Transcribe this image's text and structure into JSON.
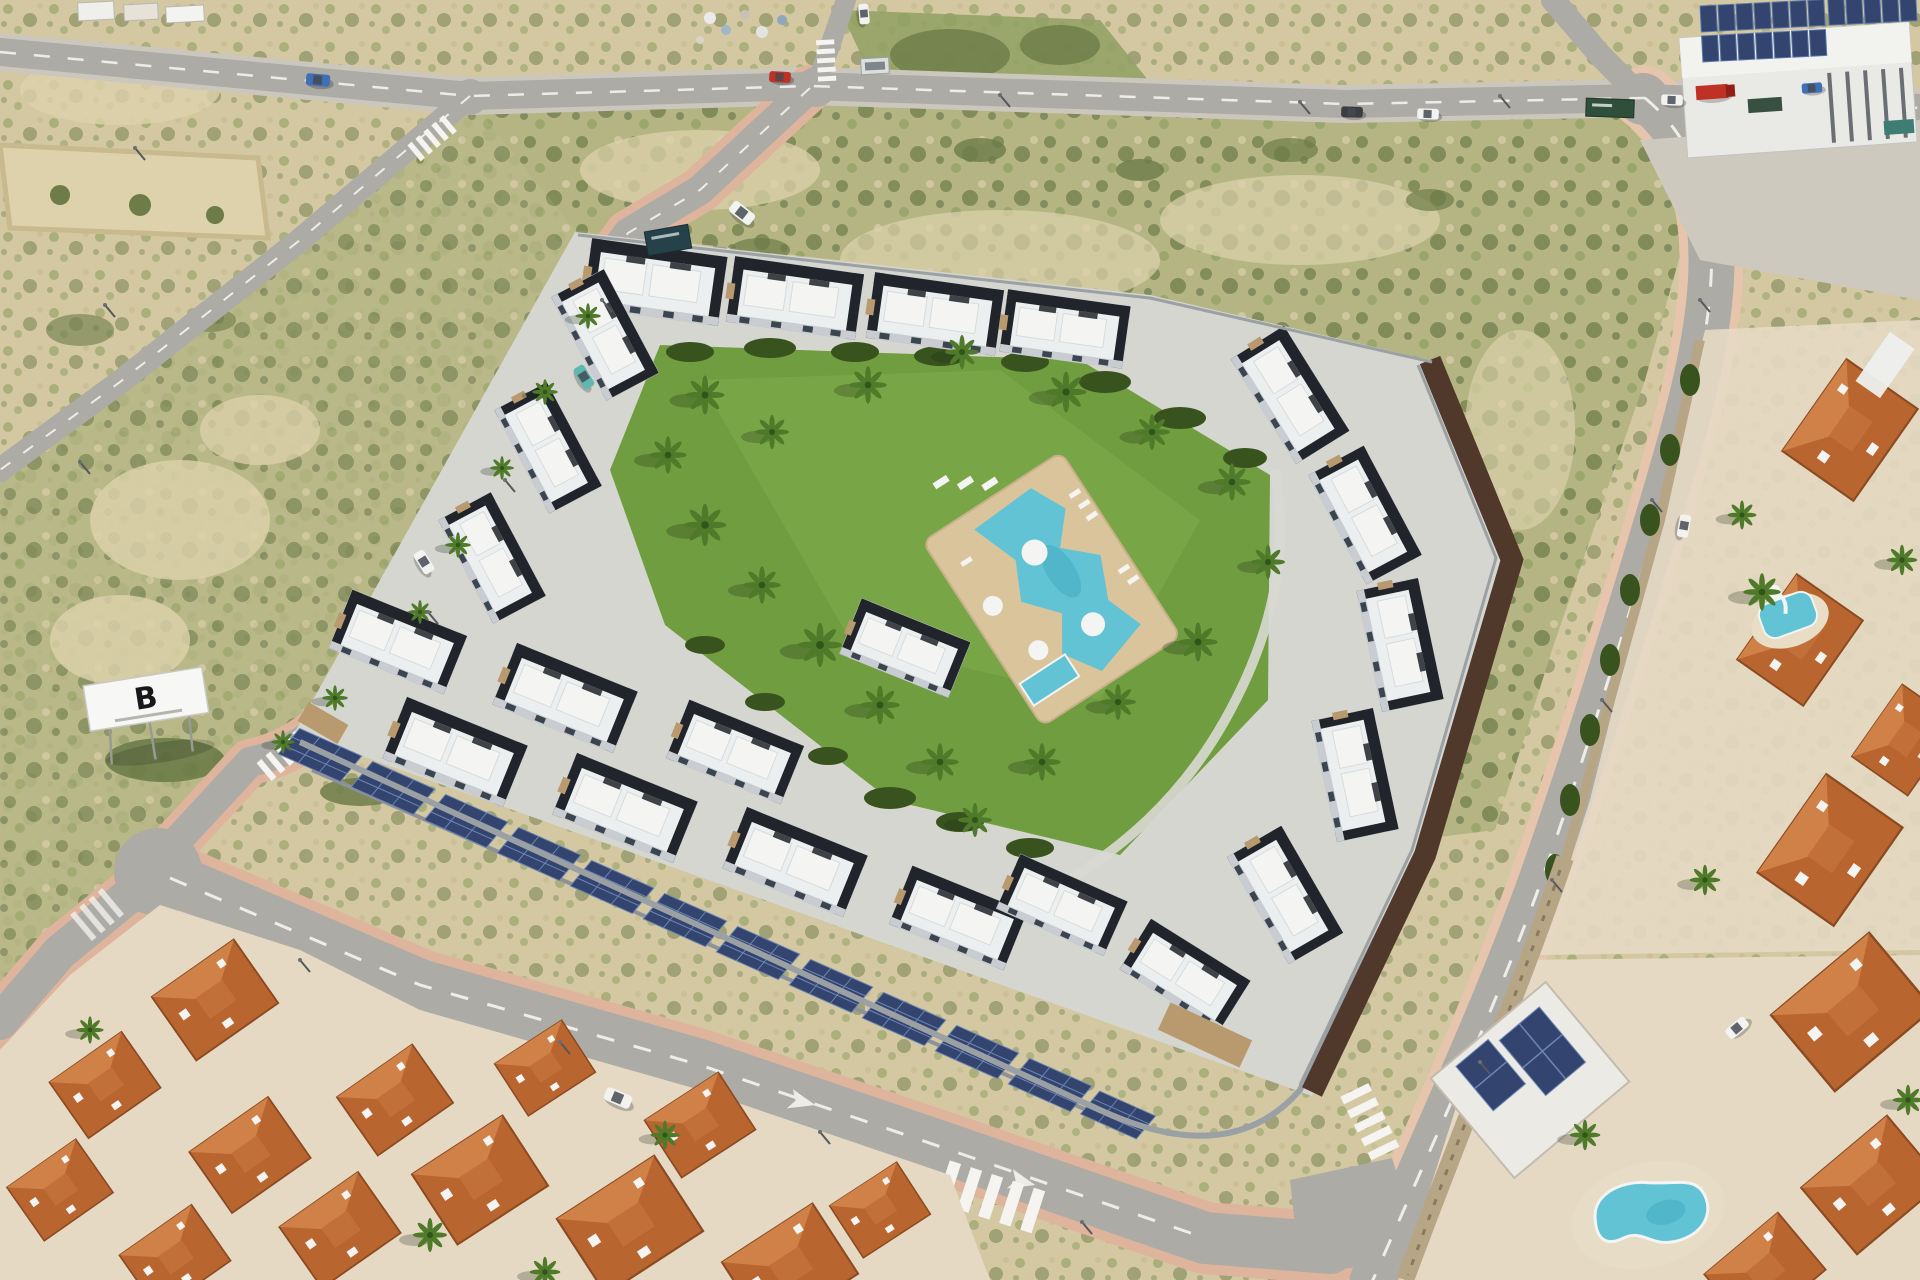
{
  "image": {
    "kind": "aerial-architectural-render",
    "width": 1920,
    "height": 1280
  },
  "billboard": {
    "letter": "B"
  },
  "palette": {
    "scrubBase": "#d3c8a2",
    "scrubGreen": "#93a265",
    "scrubDark": "#6d7c49",
    "sand": "#ddd2ac",
    "roadAsphalt": "#adaba6",
    "roadLine": "#f5f4f0",
    "sidewalkPink": "#dfb49c",
    "sidewalkPink2": "#e7c5ad",
    "lawn": "#6f9d3f",
    "lawnLight": "#82ae4d",
    "hedge": "#39531f",
    "palmGreen": "#4e7a2a",
    "palmDark": "#2f5518",
    "poolWater": "#62c3d5",
    "poolWaterDeep": "#3fa9c0",
    "poolDeck": "#d9c49b",
    "buildingWhite": "#eceff0",
    "buildingDark": "#21242a",
    "buildingShade": "#c9ccd0",
    "glass": "#3a4550",
    "stone": "#b99a6e",
    "solar": "#33456e",
    "wallGray": "#9aa0a4",
    "perimeterBrown": "#50392a",
    "roofTerra": "#b9652f",
    "roofTerraLight": "#cf8147",
    "townGround": "#e6d9c4",
    "truckRed": "#c03125",
    "carBlue": "#3f6fb5",
    "carTeal": "#5fb8b0",
    "carWhite": "#f2f2f0",
    "carDark": "#3a3d42",
    "signGreen": "#2e4f3a",
    "signDark": "#25424a",
    "containerTeal": "#3e7d74"
  },
  "scene": {
    "development": {
      "style": "modern white and black townhouse complex",
      "building_blocks": 22,
      "solar_carport_panels": 12,
      "garden_palm_trees": 18,
      "pool": {
        "shape": "lagoon",
        "umbrellas": 2,
        "kids_pool": true,
        "sun_loungers": true
      }
    },
    "surroundings": {
      "old_town_houses": 13,
      "east_villas": 8,
      "private_pools": 2,
      "industrial_building_with_solar_roof": true,
      "vacant_scrubland_lots": true
    },
    "vehicles": [
      {
        "color": "blue",
        "location": "top-left road"
      },
      {
        "color": "red",
        "location": "top middle junction"
      },
      {
        "color": "white",
        "location": "north branch road"
      },
      {
        "color": "white",
        "location": "west road"
      },
      {
        "color": "dark-gray",
        "location": "top road"
      },
      {
        "color": "white",
        "location": "top road"
      },
      {
        "color": "white",
        "location": "top road east"
      },
      {
        "color": "teal",
        "location": "west road parked"
      },
      {
        "color": "white",
        "location": "west road parked"
      },
      {
        "color": "white",
        "location": "bottom road"
      },
      {
        "color": "white",
        "location": "east road"
      },
      {
        "color": "red-truck",
        "location": "industrial forecourt"
      },
      {
        "color": "white",
        "location": "villa driveway"
      }
    ]
  }
}
